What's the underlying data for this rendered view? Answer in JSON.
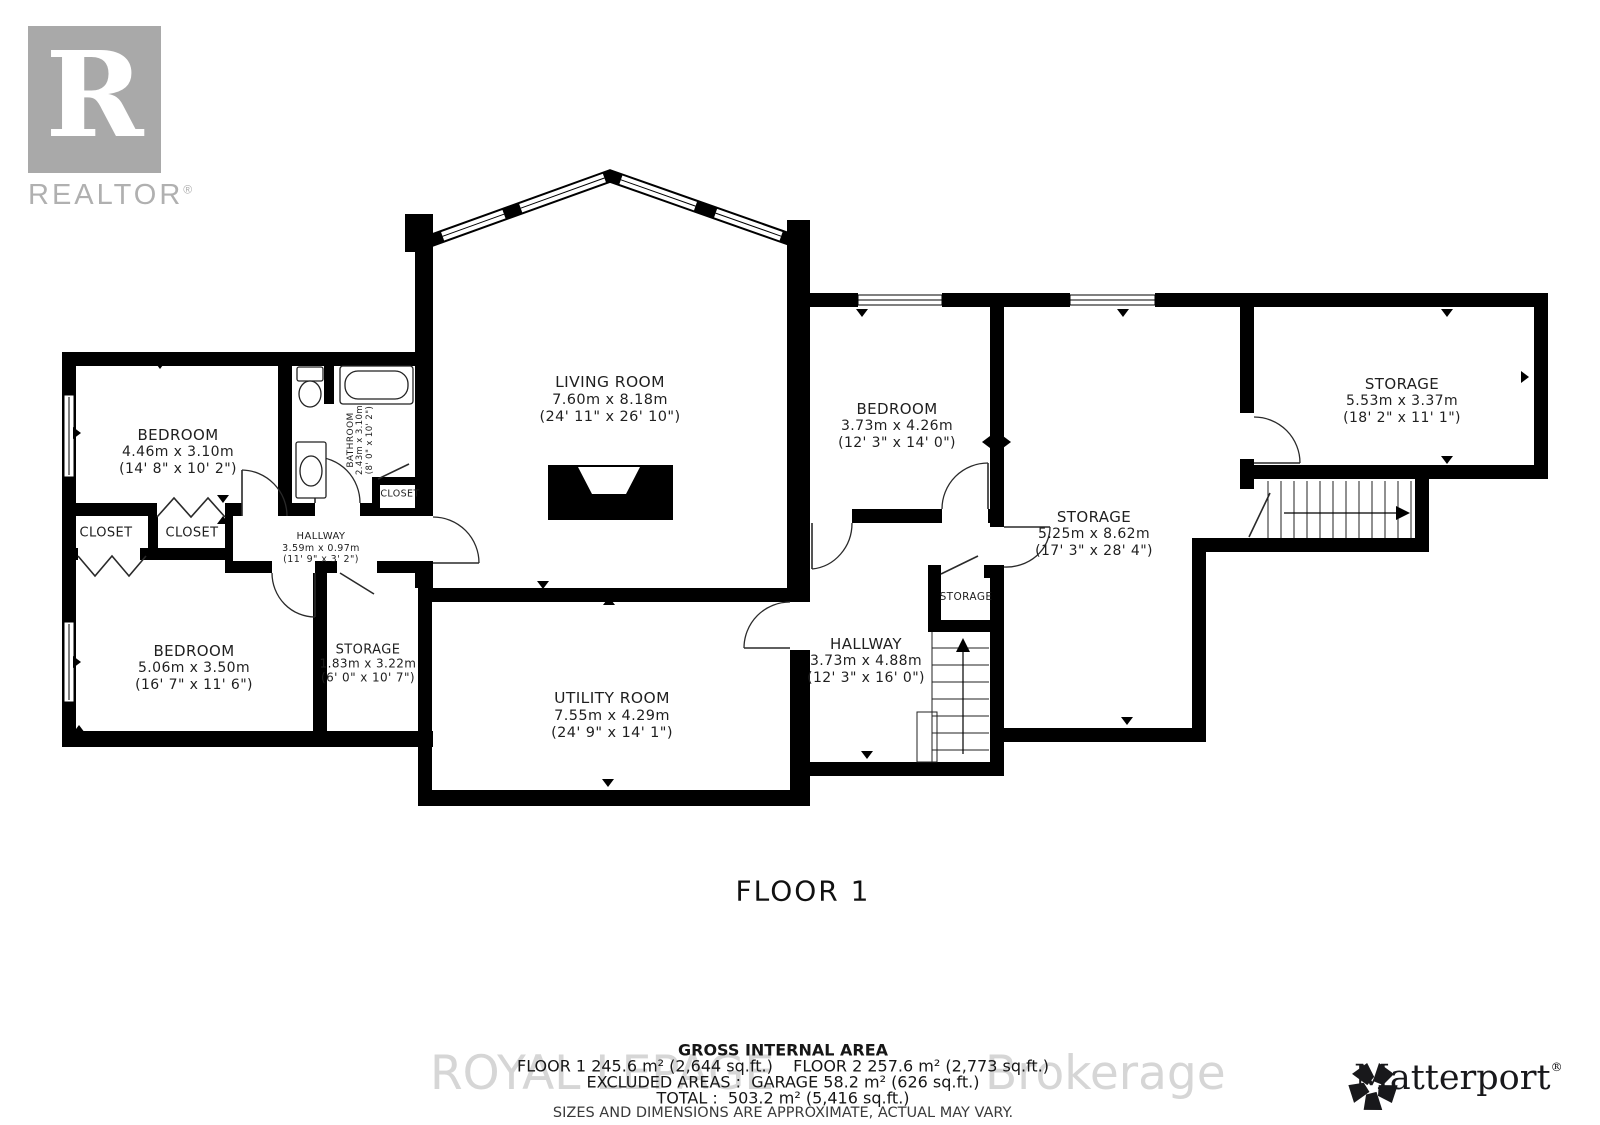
{
  "branding": {
    "realtor": {
      "letter": "R",
      "label": "REALTOR",
      "reg": "®"
    },
    "matterport": {
      "label": "Matterport",
      "reg": "®"
    },
    "watermark": {
      "left": "ROYAL LEPAGE",
      "right": "Brokerage"
    }
  },
  "floor": {
    "label": "FLOOR 1"
  },
  "summary": {
    "title": "GROSS INTERNAL AREA",
    "line1": "FLOOR 1 245.6 m² (2,644 sq.ft.)    FLOOR 2 257.6 m² (2,773 sq.ft.)",
    "line2": "EXCLUDED AREAS :  GARAGE 58.2 m² (626 sq.ft.)",
    "line3": "TOTAL :  503.2 m² (5,416 sq.ft.)",
    "disclaimer": "SIZES AND DIMENSIONS ARE APPROXIMATE, ACTUAL MAY VARY."
  },
  "rooms": [
    {
      "id": "bedroom-nw",
      "name": "BEDROOM",
      "dim_m": "4.46m x 3.10m",
      "dim_ft": "(14' 8\" x 10' 2\")",
      "x": 178,
      "y": 452,
      "ns": 15,
      "ds": 14
    },
    {
      "id": "bathroom",
      "name": "BATHROOM",
      "dim_m": "2.43m x 3.10m",
      "dim_ft": "(8' 0\" x 10' 2\")",
      "x": 361,
      "y": 440,
      "ns": 9,
      "ds": 8.5,
      "rot": -90
    },
    {
      "id": "closet-bathroom",
      "name": "CLOSET",
      "x": 400,
      "y": 494,
      "ns": 9.5
    },
    {
      "id": "closet-a",
      "name": "CLOSET",
      "x": 106,
      "y": 533,
      "ns": 13
    },
    {
      "id": "closet-b",
      "name": "CLOSET",
      "x": 192,
      "y": 533,
      "ns": 13
    },
    {
      "id": "hallway-west",
      "name": "HALLWAY",
      "dim_m": "3.59m x 0.97m",
      "dim_ft": "(11' 9\" x 3' 2\")",
      "x": 321,
      "y": 548,
      "ns": 10,
      "ds": 9.5
    },
    {
      "id": "bedroom-sw",
      "name": "BEDROOM",
      "dim_m": "5.06m x 3.50m",
      "dim_ft": "(16' 7\" x 11' 6\")",
      "x": 194,
      "y": 668,
      "ns": 15,
      "ds": 14
    },
    {
      "id": "storage-west",
      "name": "STORAGE",
      "dim_m": "1.83m x 3.22m",
      "dim_ft": "(6' 0\" x 10' 7\")",
      "x": 368,
      "y": 664,
      "ns": 13,
      "ds": 12
    },
    {
      "id": "living-room",
      "name": "LIVING ROOM",
      "dim_m": "7.60m x 8.18m",
      "dim_ft": "(24' 11\" x 26' 10\")",
      "x": 610,
      "y": 400,
      "ns": 15.5,
      "ds": 14.5
    },
    {
      "id": "utility-room",
      "name": "UTILITY ROOM",
      "dim_m": "7.55m x 4.29m",
      "dim_ft": "(24' 9\" x 14' 1\")",
      "x": 612,
      "y": 716,
      "ns": 15.5,
      "ds": 14.5
    },
    {
      "id": "bedroom-east",
      "name": "BEDROOM",
      "dim_m": "3.73m x 4.26m",
      "dim_ft": "(12' 3\" x 14' 0\")",
      "x": 897,
      "y": 426,
      "ns": 15,
      "ds": 14
    },
    {
      "id": "storage-main",
      "name": "STORAGE",
      "dim_m": "5.25m x 8.62m",
      "dim_ft": "(17' 3\" x 28' 4\")",
      "x": 1094,
      "y": 534,
      "ns": 15,
      "ds": 14
    },
    {
      "id": "hallway-east",
      "name": "HALLWAY",
      "dim_m": "3.73m x 4.88m",
      "dim_ft": "(12' 3\" x 16' 0\")",
      "x": 866,
      "y": 661,
      "ns": 15,
      "ds": 14
    },
    {
      "id": "storage-under-stairs",
      "name": "STORAGE",
      "x": 966,
      "y": 597,
      "ns": 10.5
    },
    {
      "id": "storage-ne",
      "name": "STORAGE",
      "dim_m": "5.53m x 3.37m",
      "dim_ft": "(18' 2\" x 11' 1\")",
      "x": 1402,
      "y": 401,
      "ns": 15,
      "ds": 14
    }
  ]
}
